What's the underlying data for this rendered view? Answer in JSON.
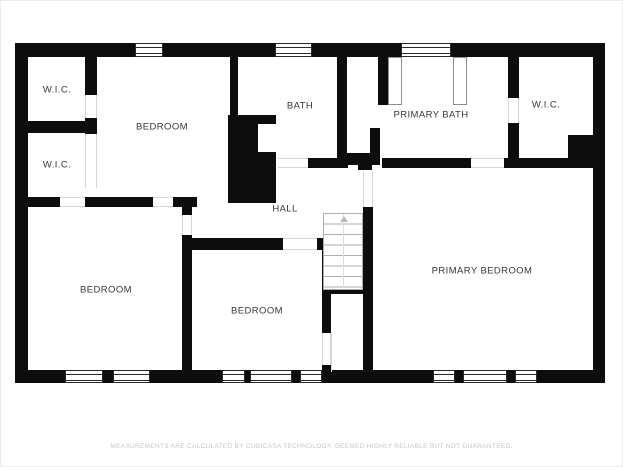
{
  "plan": {
    "type": "floor-plan",
    "rooms": {
      "wic_top_left": "W.I.C.",
      "wic_bottom_left": "W.I.C.",
      "bedroom_top": "BEDROOM",
      "bath": "BATH",
      "primary_bath": "PRIMARY BATH",
      "wic_top_right": "W.I.C.",
      "hall": "HALL",
      "bedroom_bottom_left": "BEDROOM",
      "bedroom_bottom_middle": "BEDROOM",
      "primary_bedroom": "PRIMARY BEDROOM"
    },
    "features": {
      "staircase": "stairs with up direction arrow",
      "windows_top": 3,
      "windows_bottom": 8,
      "shower_panels": 2
    },
    "colors": {
      "wall": "#0d0d0d",
      "background": "#ffffff",
      "label_text": "#383838",
      "disclaimer_text": "#c6c6c6",
      "door_opening_line": "#d6d6d6",
      "stair_line": "#aeaeae"
    }
  },
  "disclaimer": "MEASUREMENTS ARE CALCULATED BY CUBICASA TECHNOLOGY. DEEMED HIGHLY RELIABLE BUT NOT GUARANTEED."
}
